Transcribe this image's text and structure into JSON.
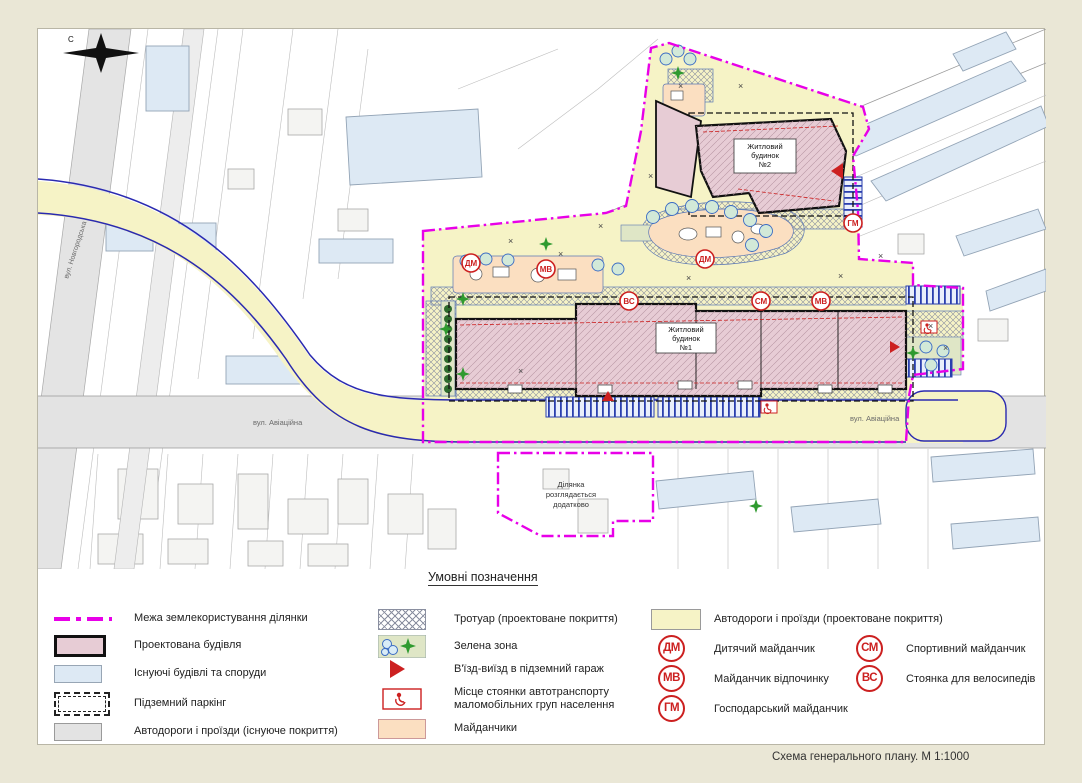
{
  "window": {
    "caption": "Схема  генерального плану. М 1:1000"
  },
  "legend": {
    "title": "Умовні позначення",
    "left": [
      {
        "label": "Межа землекористування ділянки"
      },
      {
        "label": "Проектована будівля"
      },
      {
        "label": "Існуючі будівлі та споруди"
      },
      {
        "label": "Підземний паркінг"
      },
      {
        "label": "Автодороги і проїзди (існуюче покриття)"
      }
    ],
    "middle": [
      {
        "label": "Тротуар (проектоване покриття)"
      },
      {
        "label": "Зелена зона"
      },
      {
        "label": "В'їзд-виїзд в підземний гараж"
      },
      {
        "label_line1": "Місце стоянки автотранспорту",
        "label_line2": "маломобільних груп населення"
      },
      {
        "label": "Майданчики"
      }
    ],
    "right_road_label": "Автодороги і проїзди (проектоване покриття)",
    "badges": [
      {
        "code": "ДМ",
        "label": "Дитячий майданчик"
      },
      {
        "code": "МВ",
        "label": "Майданчик відпочинку"
      },
      {
        "code": "ГМ",
        "label": "Господарський майданчик"
      },
      {
        "code": "СМ",
        "label": "Спортивний майданчик"
      },
      {
        "code": "ВС",
        "label": "Стоянка для велосипедів"
      }
    ]
  },
  "map": {
    "north_letter": "С",
    "street_novgorodska": "вул. Новгородська",
    "street_aviatsiina": "вул. Авіаційна",
    "building1": {
      "l1": "Житловий",
      "l2": "будинок",
      "l3": "№1"
    },
    "building2": {
      "l1": "Житловий",
      "l2": "будинок",
      "l3": "№2"
    },
    "parcel": {
      "l1": "Ділянка",
      "l2": "розглядається",
      "l3": "додатково"
    },
    "x_mark": "×",
    "badges": [
      {
        "code": "ДМ"
      },
      {
        "code": "МВ"
      },
      {
        "code": "ВС"
      },
      {
        "code": "ДМ"
      },
      {
        "code": "СМ"
      },
      {
        "code": "МВ"
      },
      {
        "code": "ГМ"
      }
    ]
  },
  "colors": {
    "background": "#eae7d6",
    "panel": "#ffffff",
    "boundary_magenta": "#e800e8",
    "projected_building": "#e7ccd5",
    "existing_building": "#dde9f4",
    "existing_road": "#e3e3e3",
    "projected_road": "#f6f3c6",
    "sidewalk_hatch": "#8a8fa0",
    "green_zone": "#dfe6c6",
    "playground": "#fbdfc1",
    "badge_red": "#cc2020",
    "road_edge_blue": "#2a2ab0"
  }
}
